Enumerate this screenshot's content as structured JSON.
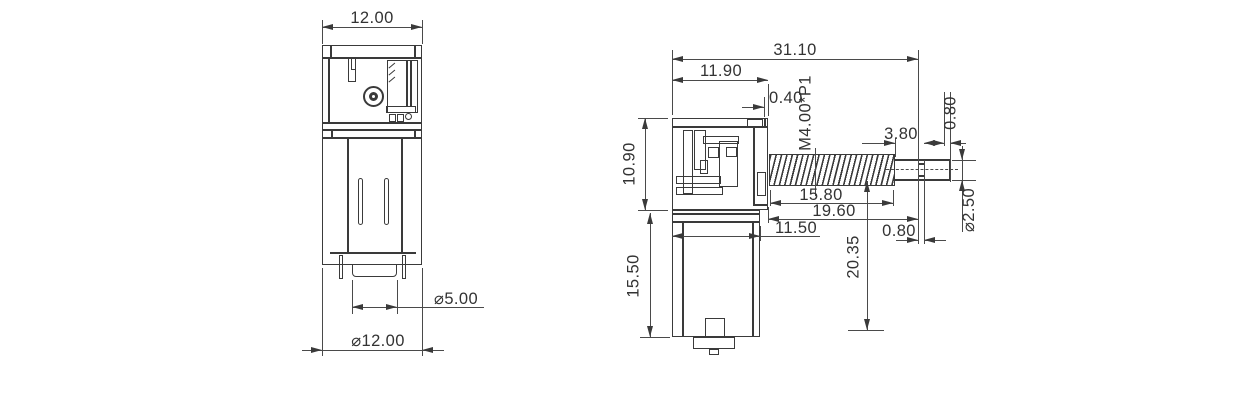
{
  "drawing": {
    "line_color": "#3a3a3a",
    "front_view": {
      "dim_width_top": "12.00",
      "dim_boss_dia": "⌀5.00",
      "dim_body_dia": "⌀12.00"
    },
    "side_view": {
      "dim_overall_length": "31.10",
      "dim_gearbox_length": "11.90",
      "dim_face_step": "0.40",
      "thread_spec": "M4.00*P1",
      "dim_thread_runout": "3.80",
      "dim_tip_step": "0.80",
      "dim_gearbox_height": "10.90",
      "dim_thread_length": "15.80",
      "dim_screw_length": "19.60",
      "dim_shaft_tip_dia": "⌀2.50",
      "dim_motor_width": "11.50",
      "dim_groove_width": "0.80",
      "dim_motor_length": "15.50",
      "dim_axis_to_base": "20.35"
    }
  }
}
